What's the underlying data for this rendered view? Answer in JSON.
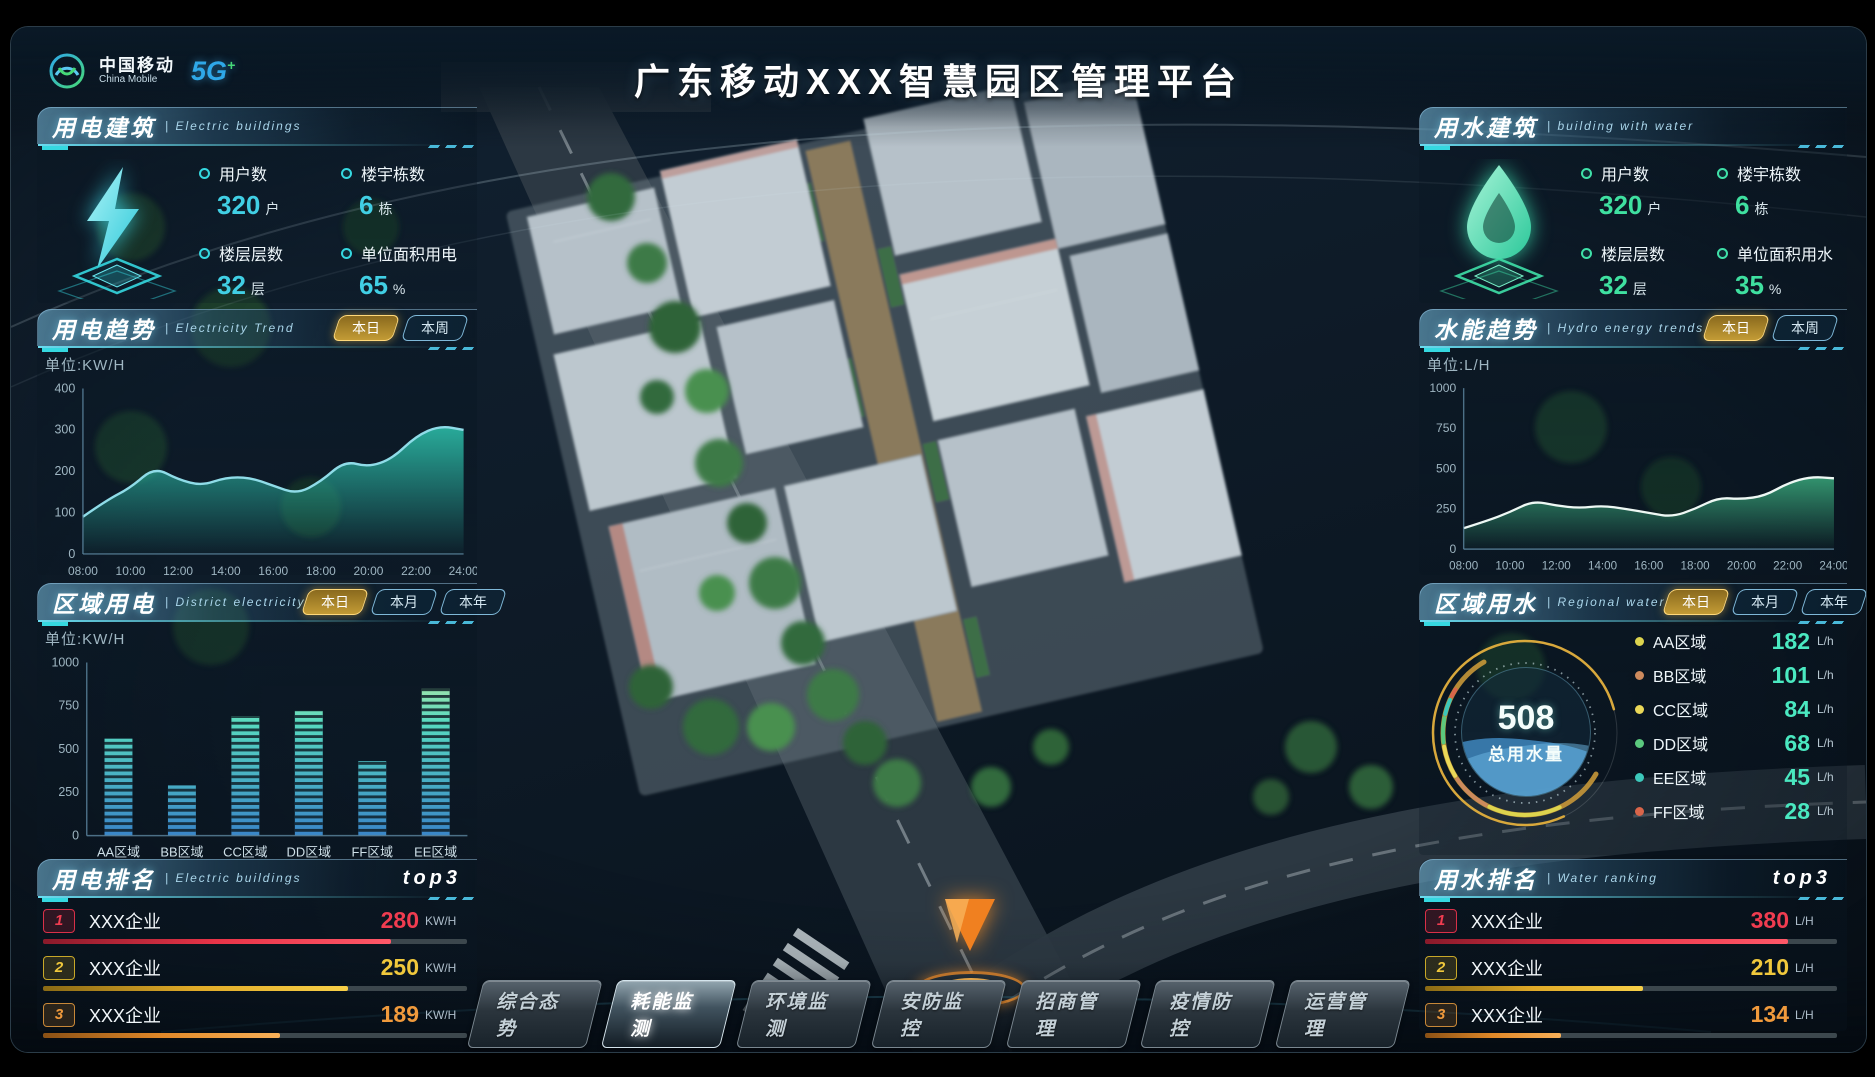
{
  "header": {
    "title": "广东移动XXX智慧园区管理平台",
    "logo": {
      "cn": "中国移动",
      "en": "China Mobile",
      "badge_5g": "5G",
      "badge_plus": "+"
    }
  },
  "colors": {
    "accent_cyan": "#35d8e0",
    "accent_green": "#3fe0a8",
    "tab_active_gold": "#c39b35",
    "rank1_red": "#f03c50",
    "rank2_gold": "#f0c83c",
    "rank3_orange": "#f09a3c"
  },
  "panels": {
    "elec_building": {
      "title": "用电建筑",
      "subtitle": "| Electric buildings",
      "stats": [
        {
          "label": "用户数",
          "value": "320",
          "unit": "户"
        },
        {
          "label": "楼宇栋数",
          "value": "6",
          "unit": "栋"
        },
        {
          "label": "楼层层数",
          "value": "32",
          "unit": "层"
        },
        {
          "label": "单位面积用电",
          "value": "65",
          "unit": "%"
        }
      ]
    },
    "elec_trend": {
      "title": "用电趋势",
      "subtitle": "| Electricity Trend",
      "unit_label": "单位:KW/H",
      "tabs": [
        {
          "label": "本日",
          "active": true
        },
        {
          "label": "本周",
          "active": false
        }
      ]
    },
    "district_elec": {
      "title": "区域用电",
      "subtitle": "| District electricity",
      "unit_label": "单位:KW/H",
      "tabs": [
        {
          "label": "本日",
          "active": true
        },
        {
          "label": "本月",
          "active": false
        },
        {
          "label": "本年",
          "active": false
        }
      ]
    },
    "elec_rank": {
      "title": "用电排名",
      "subtitle": "| Electric buildings",
      "badge": "top3",
      "items": [
        {
          "rank": "1",
          "name": "XXX企业",
          "value": "280",
          "unit": "KW/H",
          "bar_pct": 82
        },
        {
          "rank": "2",
          "name": "XXX企业",
          "value": "250",
          "unit": "KW/H",
          "bar_pct": 72
        },
        {
          "rank": "3",
          "name": "XXX企业",
          "value": "189",
          "unit": "KW/H",
          "bar_pct": 56
        }
      ]
    },
    "water_building": {
      "title": "用水建筑",
      "subtitle": "| building with water",
      "stats": [
        {
          "label": "用户数",
          "value": "320",
          "unit": "户"
        },
        {
          "label": "楼宇栋数",
          "value": "6",
          "unit": "栋"
        },
        {
          "label": "楼层层数",
          "value": "32",
          "unit": "层"
        },
        {
          "label": "单位面积用水",
          "value": "35",
          "unit": "%"
        }
      ]
    },
    "water_trend": {
      "title": "水能趋势",
      "subtitle": "| Hydro energy trends",
      "unit_label": "单位:L/H",
      "tabs": [
        {
          "label": "本日",
          "active": true
        },
        {
          "label": "本周",
          "active": false
        }
      ]
    },
    "water_region": {
      "title": "区域用水",
      "subtitle": "| Regional water",
      "tabs": [
        {
          "label": "本日",
          "active": true
        },
        {
          "label": "本月",
          "active": false
        },
        {
          "label": "本年",
          "active": false
        }
      ],
      "gauge": {
        "total": "508",
        "label": "总用水量"
      },
      "legend": [
        {
          "name": "AA区域",
          "value": "182",
          "unit": "L/h",
          "color": "#ddd44e"
        },
        {
          "name": "BB区域",
          "value": "101",
          "unit": "L/h",
          "color": "#cd8a5d"
        },
        {
          "name": "CC区域",
          "value": "84",
          "unit": "L/h",
          "color": "#ead858"
        },
        {
          "name": "DD区域",
          "value": "68",
          "unit": "L/h",
          "color": "#5bc97e"
        },
        {
          "name": "EE区域",
          "value": "45",
          "unit": "L/h",
          "color": "#3cc8bb"
        },
        {
          "name": "FF区域",
          "value": "28",
          "unit": "L/h",
          "color": "#d9654a"
        }
      ]
    },
    "water_rank": {
      "title": "用水排名",
      "subtitle": "| Water ranking",
      "badge": "top3",
      "items": [
        {
          "rank": "1",
          "name": "XXX企业",
          "value": "380",
          "unit": "L/H",
          "bar_pct": 88
        },
        {
          "rank": "2",
          "name": "XXX企业",
          "value": "210",
          "unit": "L/H",
          "bar_pct": 53
        },
        {
          "rank": "3",
          "name": "XXX企业",
          "value": "134",
          "unit": "L/H",
          "bar_pct": 33
        }
      ]
    }
  },
  "nav": {
    "items": [
      {
        "label": "综合态势",
        "active": false
      },
      {
        "label": "耗能监测",
        "active": true
      },
      {
        "label": "环境监测",
        "active": false
      },
      {
        "label": "安防监控",
        "active": false
      },
      {
        "label": "招商管理",
        "active": false
      },
      {
        "label": "疫情防控",
        "active": false
      },
      {
        "label": "运营管理",
        "active": false
      }
    ]
  },
  "chart_data": [
    {
      "id": "elec_trend_chart",
      "type": "area",
      "title": "用电趋势 Electricity Trend (本日)",
      "ylabel": "单位:KW/H",
      "x": [
        "08:00",
        "09:00",
        "10:00",
        "11:00",
        "12:00",
        "13:00",
        "14:00",
        "15:00",
        "16:00",
        "17:00",
        "18:00",
        "19:00",
        "20:00",
        "21:00",
        "22:00",
        "23:00",
        "24:00"
      ],
      "values": [
        90,
        130,
        160,
        210,
        180,
        165,
        185,
        185,
        165,
        145,
        175,
        225,
        210,
        230,
        285,
        310,
        300
      ],
      "ylim": [
        0,
        400
      ],
      "yticks": [
        0,
        100,
        200,
        300,
        400
      ],
      "xticks": [
        "08:00",
        "10:00",
        "12:00",
        "14:00",
        "16:00",
        "18:00",
        "20:00",
        "22:00",
        "24:00"
      ],
      "line_color": "#8fdce8",
      "fill_color": "#2ec4ae",
      "grid": false
    },
    {
      "id": "district_elec_chart",
      "type": "bar",
      "title": "区域用电 District electricity (本日)",
      "ylabel": "单位:KW/H",
      "categories": [
        "AA区域",
        "BB区域",
        "CC区域",
        "DD区域",
        "FF区域",
        "EE区域"
      ],
      "values": [
        560,
        290,
        690,
        720,
        430,
        850
      ],
      "ylim": [
        0,
        1000
      ],
      "yticks": [
        0,
        250,
        500,
        750,
        1000
      ],
      "bar_color_top": "#c6eda0",
      "bar_color_mid": "#57d8c0",
      "bar_color_bottom": "#3a86c8",
      "grid": false
    },
    {
      "id": "water_trend_chart",
      "type": "area",
      "title": "水能趋势 Hydro energy trends (本日)",
      "ylabel": "单位:L/H",
      "x": [
        "08:00",
        "09:00",
        "10:00",
        "11:00",
        "12:00",
        "13:00",
        "14:00",
        "15:00",
        "16:00",
        "17:00",
        "18:00",
        "19:00",
        "20:00",
        "21:00",
        "22:00",
        "23:00",
        "24:00"
      ],
      "values": [
        130,
        175,
        230,
        300,
        270,
        255,
        270,
        250,
        225,
        200,
        250,
        320,
        310,
        330,
        410,
        450,
        440
      ],
      "ylim": [
        0,
        1000
      ],
      "yticks": [
        0,
        250,
        500,
        750,
        1000
      ],
      "xticks": [
        "08:00",
        "10:00",
        "12:00",
        "14:00",
        "16:00",
        "18:00",
        "20:00",
        "22:00",
        "24:00"
      ],
      "line_color": "#eef8f4",
      "fill_color": "#3aa97c",
      "grid": false
    },
    {
      "id": "water_gauge",
      "type": "pie",
      "title": "区域用水 Regional water (本日)",
      "total": 508,
      "center_label": "总用水量",
      "segments": [
        {
          "name": "AA区域",
          "value": 182,
          "color": "#ddd44e"
        },
        {
          "name": "BB区域",
          "value": 101,
          "color": "#cd8a5d"
        },
        {
          "name": "CC区域",
          "value": 84,
          "color": "#ead858"
        },
        {
          "name": "DD区域",
          "value": 68,
          "color": "#5bc97e"
        },
        {
          "name": "EE区域",
          "value": 45,
          "color": "#3cc8bb"
        },
        {
          "name": "FF区域",
          "value": 28,
          "color": "#d9654a"
        }
      ]
    }
  ]
}
